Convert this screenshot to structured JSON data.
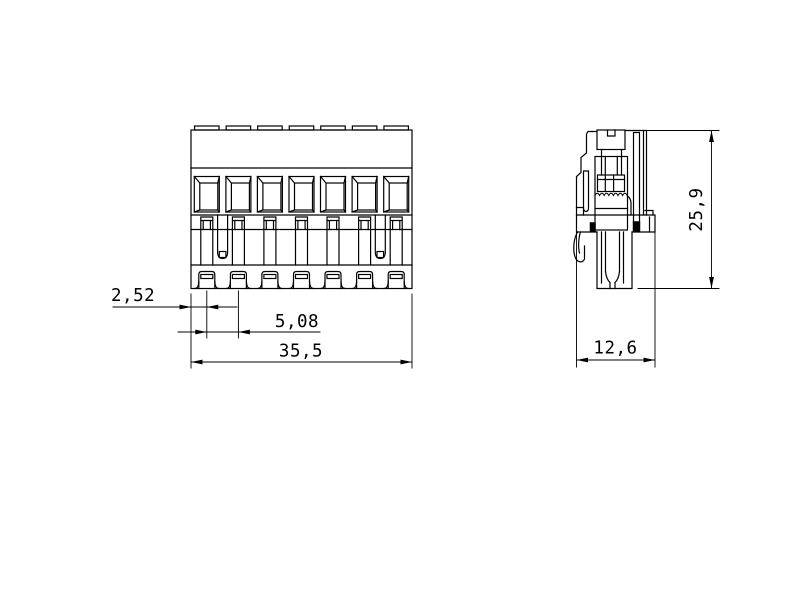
{
  "drawing": {
    "background_color": "#ffffff",
    "line_color": "#000000",
    "front_view": {
      "positions": 7
    },
    "side_view": {},
    "dimensions": {
      "pin_offset": "2,52",
      "pitch": "5,08",
      "overall_width": "35,5",
      "depth": "12,6",
      "height": "25,9"
    }
  }
}
